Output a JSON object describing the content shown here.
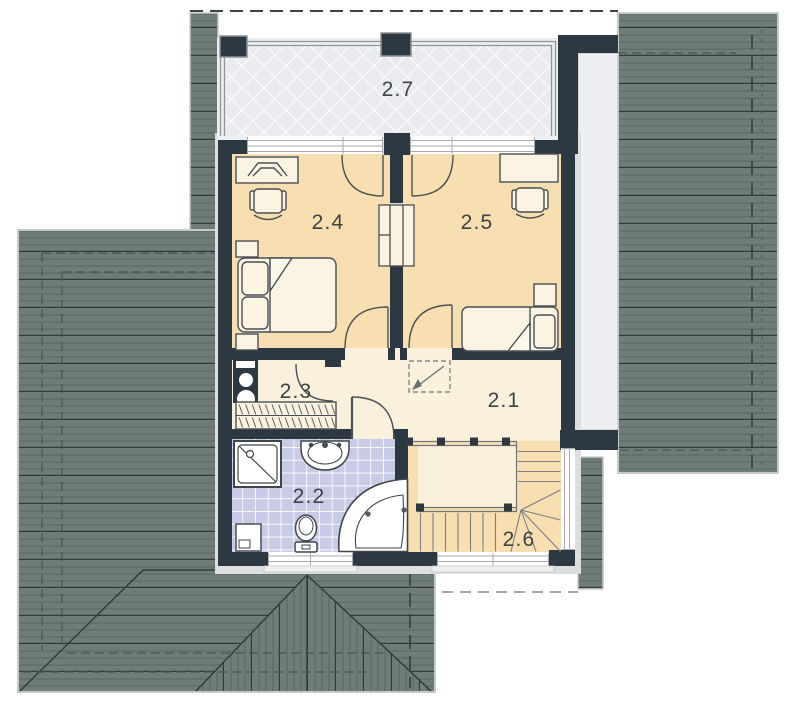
{
  "rooms": [
    {
      "id": "room-2-1",
      "label": "2.1"
    },
    {
      "id": "room-2-2",
      "label": "2.2"
    },
    {
      "id": "room-2-3",
      "label": "2.3"
    },
    {
      "id": "room-2-4",
      "label": "2.4"
    },
    {
      "id": "room-2-5",
      "label": "2.5"
    },
    {
      "id": "room-2-6",
      "label": "2.6"
    },
    {
      "id": "room-2-7",
      "label": "2.7"
    }
  ],
  "colors": {
    "roof": "#6F7C78",
    "roof_line_light": "#5A6763",
    "roof_line_dark": "#2F3A3C",
    "wall": "#2C3842",
    "bedroom_floor": "#F8DFB1",
    "hall_floor": "#FAF1DC",
    "bath_tile": "#C7CBE6",
    "balcony_floor": "#E9EBEE",
    "furniture_fill": "#FBF4E2",
    "label_text": "#3D4347"
  }
}
